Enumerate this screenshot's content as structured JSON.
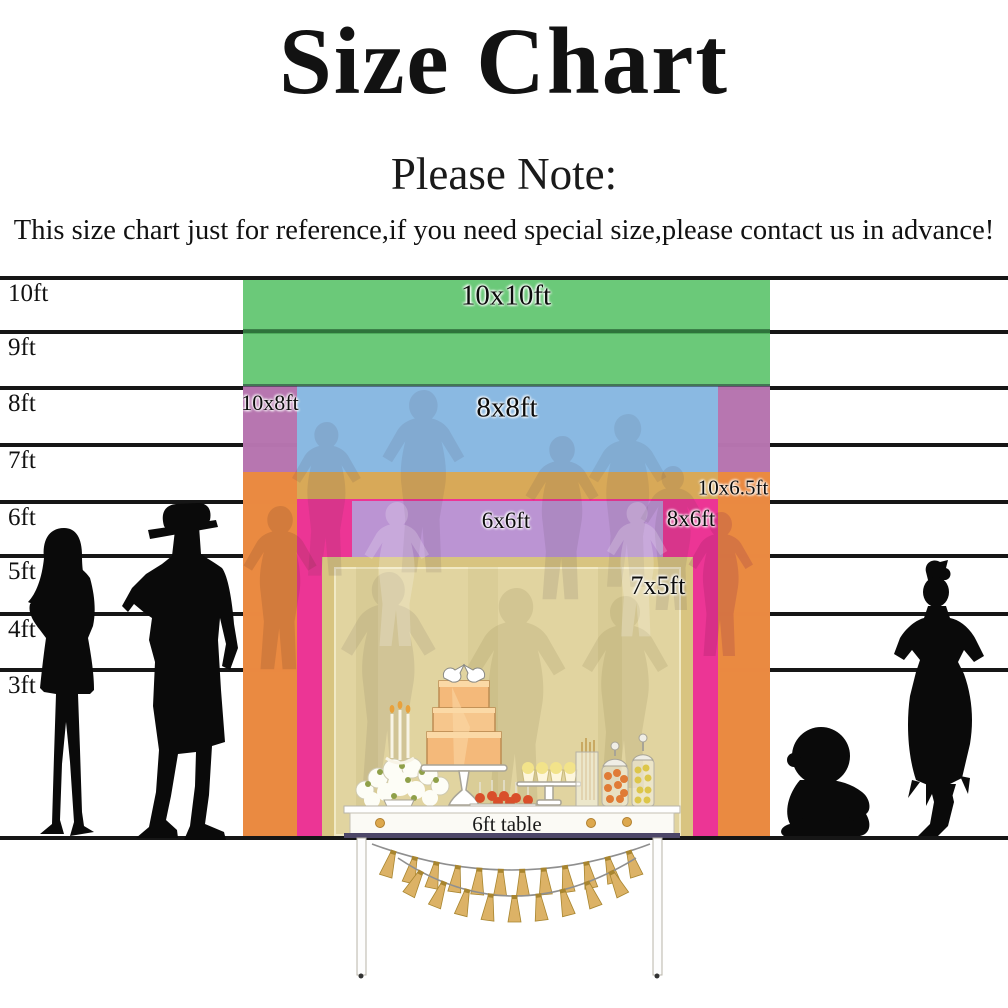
{
  "title": "Size Chart",
  "note": {
    "heading": "Please Note:",
    "body": "This size chart just for reference,if you need special size,please contact us in advance!"
  },
  "table": {
    "label": "6ft table"
  },
  "colors": {
    "green": "#56c167",
    "blue": "#88bbe3",
    "orchid": "#c06db6",
    "orange": "#ec8a3c",
    "magenta": "#eb3398",
    "lavender": "#b998d5",
    "khaki": "#d8c480",
    "line": "#161616",
    "tassel_gold": "#dcb266",
    "table_bar_navy": "#4c4668"
  },
  "chart_data": {
    "type": "size-comparison",
    "unit": "ft",
    "title": "Size Chart",
    "axis_ticks": [
      {
        "label": "10ft",
        "y": 276
      },
      {
        "label": "9ft",
        "y": 330
      },
      {
        "label": "8ft",
        "y": 386
      },
      {
        "label": "7ft",
        "y": 443
      },
      {
        "label": "6ft",
        "y": 500
      },
      {
        "label": "5ft",
        "y": 554
      },
      {
        "label": "4ft",
        "y": 612
      },
      {
        "label": "3ft",
        "y": 668
      }
    ],
    "ground_y": 836,
    "sizes": [
      {
        "label": "10x10ft",
        "width_ft": 10,
        "height_ft": 10,
        "color": "#56c167",
        "opacity": 0.88,
        "rect": {
          "x": 243,
          "y": 280,
          "w": 527,
          "h": 556
        },
        "label_pos": {
          "x": 506,
          "y": 296,
          "fs": 29
        }
      },
      {
        "label": "10x8ft",
        "width_ft": 10,
        "height_ft": 8,
        "color": "#c06db6",
        "opacity": 0.9,
        "rect": {
          "x": 243,
          "y": 386,
          "w": 527,
          "h": 450
        },
        "label_pos": {
          "x": 270,
          "y": 403,
          "fs": 22
        }
      },
      {
        "label": "8x8ft",
        "width_ft": 8,
        "height_ft": 8,
        "color": "#88bbe3",
        "opacity": 0.97,
        "rect": {
          "x": 297,
          "y": 386,
          "w": 421,
          "h": 450
        },
        "label_pos": {
          "x": 507,
          "y": 408,
          "fs": 29
        }
      },
      {
        "label": "10x6.5ft",
        "width_ft": 10,
        "height_ft": 6.5,
        "color": "#ec8a3c",
        "opacity": 0.96,
        "rect": {
          "x": 243,
          "y": 472,
          "w": 527,
          "h": 364
        },
        "label_pos": {
          "x": 733,
          "y": 488,
          "fs": 21
        }
      },
      {
        "label": "8x6ft",
        "width_ft": 8,
        "height_ft": 6,
        "color": "#eb3398",
        "opacity": 0.97,
        "rect": {
          "x": 297,
          "y": 499,
          "w": 421,
          "h": 337
        },
        "label_pos": {
          "x": 691,
          "y": 519,
          "fs": 23
        }
      },
      {
        "label": "6x6ft",
        "width_ft": 6,
        "height_ft": 6,
        "color": "#b998d5",
        "opacity": 0.97,
        "rect": {
          "x": 352,
          "y": 501,
          "w": 311,
          "h": 335
        },
        "label_pos": {
          "x": 506,
          "y": 521,
          "fs": 23
        }
      },
      {
        "label": "7x5ft",
        "width_ft": 7,
        "height_ft": 5,
        "color": "#d8c480",
        "opacity": 1,
        "rect": {
          "x": 322,
          "y": 557,
          "w": 371,
          "h": 279
        },
        "label_pos": {
          "x": 658,
          "y": 586,
          "fs": 26
        }
      }
    ],
    "extras": [
      {
        "name": "nine-ft-line-through-green",
        "x": 243,
        "y": 329,
        "w": 527,
        "h": 4,
        "color": "#0d3a19",
        "opacity": 0.5,
        "z": 15
      },
      {
        "name": "eight-ft-boundary-line",
        "x": 243,
        "y": 384,
        "w": 527,
        "h": 3,
        "color": "#1a2430",
        "opacity": 0.5,
        "z": 35
      },
      {
        "name": "orange-over-blue-strip",
        "x": 297,
        "y": 472,
        "w": 421,
        "h": 27,
        "color": "#d8a958",
        "opacity": 1,
        "z": 45
      },
      {
        "name": "khaki-inner-panel",
        "x": 334,
        "y": 567,
        "w": 347,
        "h": 269,
        "color": "#e1d4a0",
        "opacity": 1,
        "z": 75
      }
    ],
    "banner": {
      "string_color": "#8f8f8f",
      "tassel_color": "#dcb266",
      "tassel_edge": "#a8852f",
      "swags": [
        {
          "x1": 372,
          "y1": 844,
          "cx": 512,
          "cy": 896,
          "x2": 650,
          "y2": 844,
          "count": 12
        },
        {
          "x1": 398,
          "y1": 858,
          "cx": 512,
          "cy": 934,
          "x2": 636,
          "y2": 858,
          "count": 9
        }
      ]
    }
  }
}
